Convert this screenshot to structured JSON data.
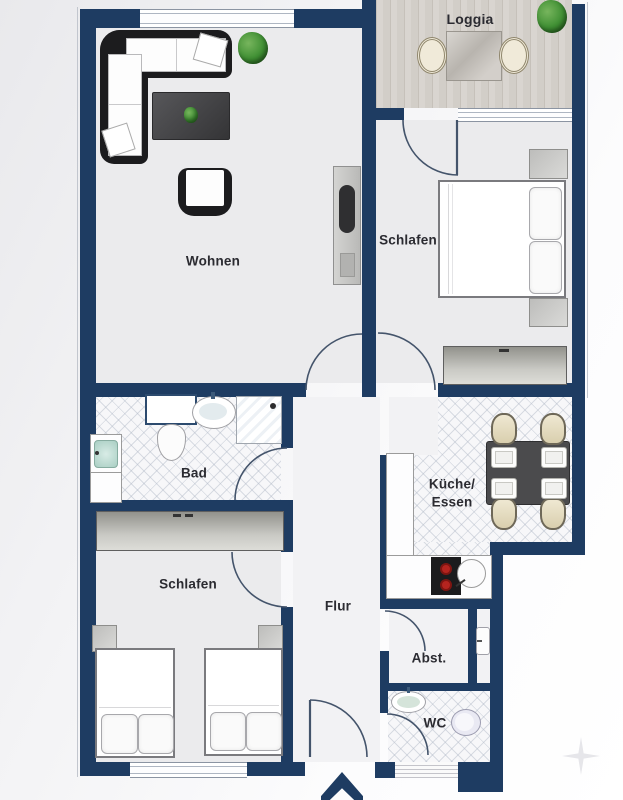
{
  "page": {
    "type": "apartment-floor-plan"
  },
  "rooms": {
    "loggia": {
      "label": "Loggia"
    },
    "wohnen": {
      "label": "Wohnen"
    },
    "schlafen_top": {
      "label": "Schlafen"
    },
    "bad": {
      "label": "Bad"
    },
    "kueche": {
      "label_line1": "Küche/",
      "label_line2": "Essen"
    },
    "schlafen_bottom": {
      "label": "Schlafen"
    },
    "flur": {
      "label": "Flur"
    },
    "abst": {
      "label": "Abst."
    },
    "wc": {
      "label": "WC"
    }
  },
  "colors": {
    "wall_navy": "#1e3c62",
    "room_floor": "#ebebed",
    "hall_floor": "#f2f2f4",
    "wood_floor": "#d8d4cf",
    "plant_green": "#3f8f33",
    "stove_burner_red": "#b4241f",
    "label_text": "#2b2b31"
  }
}
